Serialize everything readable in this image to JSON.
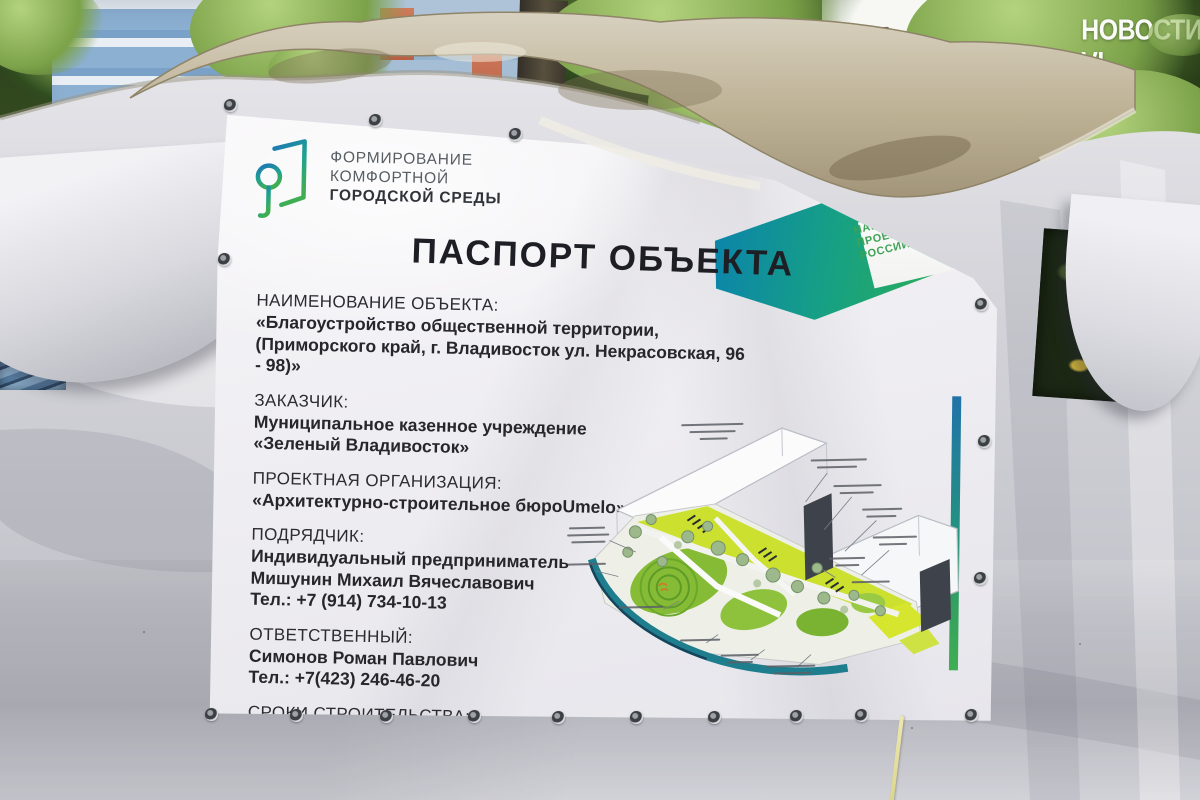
{
  "watermark": "НОВОСТИ VL",
  "program_logo": {
    "line1": "ФОРМИРОВАНИЕ",
    "line2": "КОМФОРТНОЙ",
    "line3": "ГОРОДСКОЙ СРЕДЫ"
  },
  "national_projects": {
    "line1": "НАЦИОНАЛЬНЫЕ",
    "line2": "ПРОЕКТЫ",
    "line3": "РОССИИ"
  },
  "banner": {
    "title": "ПАСПОРТ ОБЪЕКТА",
    "sections": {
      "object": {
        "label": "НАИМЕНОВАНИЕ ОБЪЕКТА:",
        "lines": [
          "«Благоустройство общественной территории,",
          "(Приморского край, г. Владивосток  ул. Некрасовская, 96 - 98)»"
        ]
      },
      "customer": {
        "label": "ЗАКАЗЧИК:",
        "lines": [
          "Муниципальное казенное учреждение",
          "«Зеленый Владивосток»"
        ]
      },
      "designer": {
        "label": "ПРОЕКТНАЯ ОРГАНИЗАЦИЯ:",
        "lines": [
          "«Архитектурно-строительное бюроUmelo»"
        ]
      },
      "contractor": {
        "label": "ПОДРЯДЧИК:",
        "lines": [
          "Индивидуальный предприниматель",
          "Мишунин Михаил Вячеславович",
          "Тел.: +7 (914) 734-10-13"
        ]
      },
      "responsible": {
        "label": "ОТВЕТСТВЕННЫЙ:",
        "lines": [
          "Симонов Роман Павлович",
          "Тел.: +7(423) 246-46-20"
        ]
      },
      "timeline": {
        "label": "СРОКИ СТРОИТЕЛЬСТВА:",
        "lines": [
          "Начало строительства – 06.05.2025",
          "Окончание строительства– 30.08.2025"
        ]
      }
    }
  },
  "colors": {
    "logo_gradient_start": "#1e74b8",
    "logo_gradient_end": "#3fae53",
    "np_gradient_start": "#0c86a8",
    "np_gradient_end": "#2fae52",
    "stripe_top": "#2272a8",
    "stripe_bottom": "#3fae53",
    "banner_bg": "#f4f3f5",
    "text": "#26262b"
  }
}
